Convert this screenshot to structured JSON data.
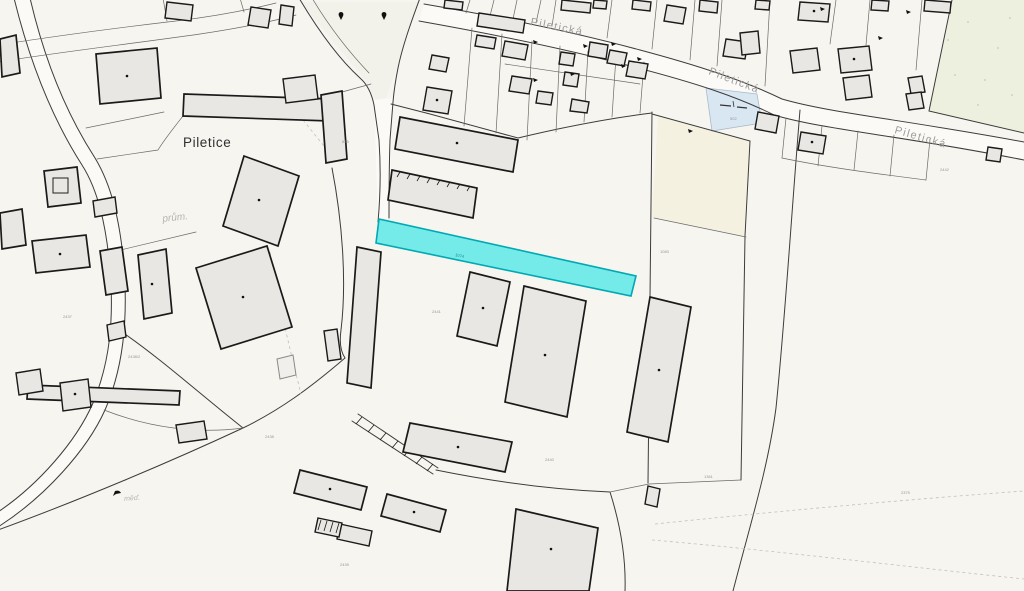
{
  "map": {
    "place_labels": {
      "village": "Piletice",
      "industrial_abbrev": "prům.",
      "landuse_abbrev": "měď."
    },
    "street": {
      "name": "Piletická",
      "occurrences": 3
    },
    "highlighted_parcel": {
      "number": "1074",
      "fill": "#74ebe9",
      "stroke": "#00a9b4"
    },
    "parcel_numbers": [
      "2437",
      "2438",
      "2439",
      "2440",
      "2441",
      "1083",
      "1361",
      "2379",
      "825",
      "2442",
      "2438/2",
      "502"
    ],
    "colors": {
      "background": "#f6f5f0",
      "parcel_line": "#3c3c3c",
      "building_fill": "#e8e7e3",
      "building_stroke": "#1a1a1a",
      "water_fill": "#d9e7f3",
      "greenery_fill": "#eef0df",
      "cream_fill": "#f5f1e1",
      "road_fill": "#fbfaf6",
      "area_label_gray": "#b8b5aa",
      "street_label_gray": "#9d9d9d"
    }
  }
}
